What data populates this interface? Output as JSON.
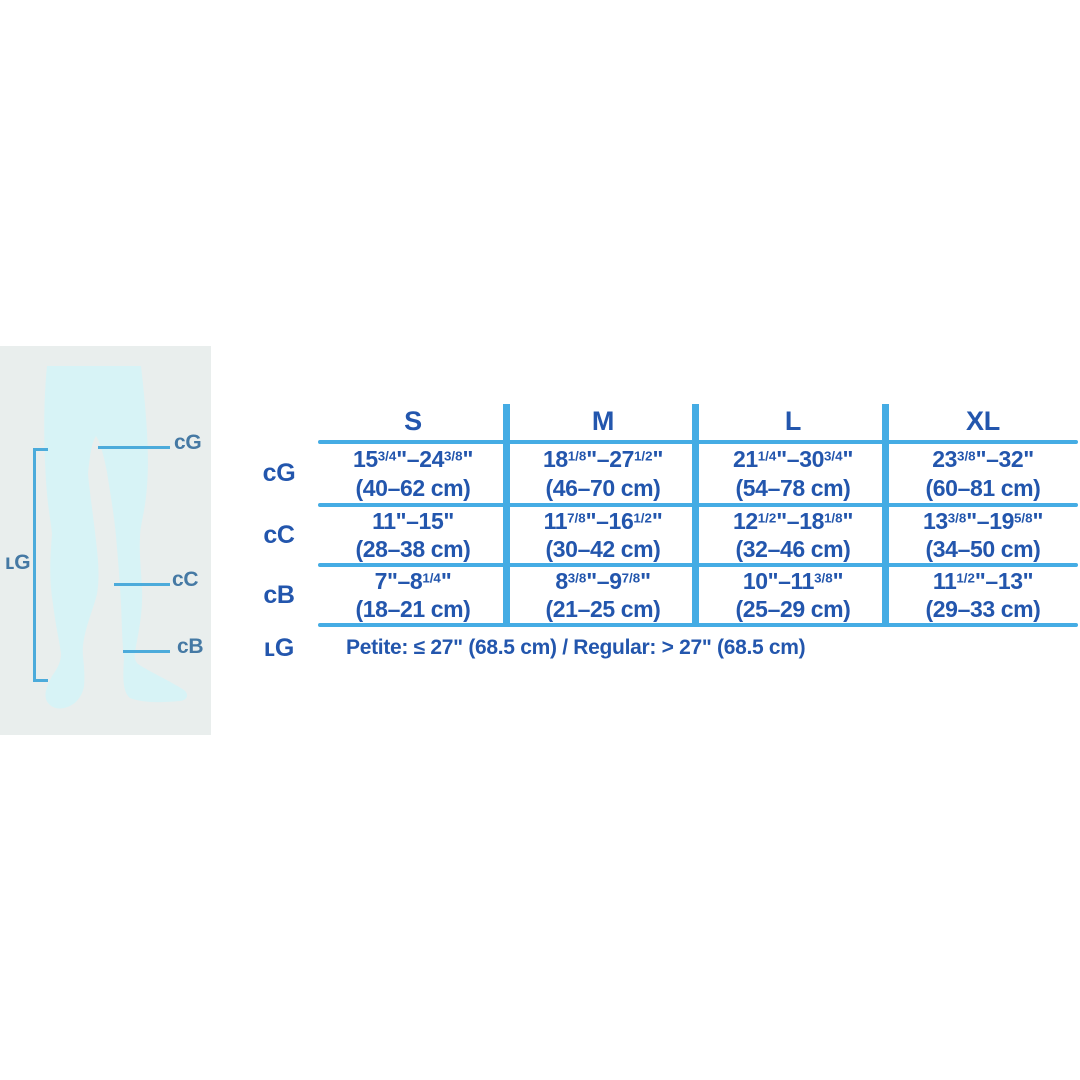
{
  "colors": {
    "t-blue": "#2356ad",
    "line-blue": "#45ace4",
    "d-line": "#4cabdb",
    "d-label": "#4579a4",
    "panel-bg": "#e9eeed",
    "legs-fill": "#d7f3f6"
  },
  "diagram": {
    "labels": {
      "cg": "cG",
      "cc": "cC",
      "cb": "cB",
      "lg": "ʟG"
    }
  },
  "table": {
    "columns": [
      "S",
      "M",
      "L",
      "XL"
    ],
    "rows": [
      {
        "label": "cG",
        "cells": [
          {
            "in": "15{3/4}\"–24{3/8}\"",
            "cm": "(40–62 cm)"
          },
          {
            "in": "18{1/8}\"–27{1/2}\"",
            "cm": "(46–70 cm)"
          },
          {
            "in": "21{1/4}\"–30{3/4}\"",
            "cm": "(54–78 cm)"
          },
          {
            "in": "23{3/8}\"–32\"",
            "cm": "(60–81 cm)"
          }
        ]
      },
      {
        "label": "cC",
        "cells": [
          {
            "in": "11\"–15\"",
            "cm": "(28–38 cm)"
          },
          {
            "in": "11{7/8}\"–16{1/2}\"",
            "cm": "(30–42 cm)"
          },
          {
            "in": "12{1/2}\"–18{1/8}\"",
            "cm": "(32–46 cm)"
          },
          {
            "in": "13{3/8}\"–19{5/8}\"",
            "cm": "(34–50 cm)"
          }
        ]
      },
      {
        "label": "cB",
        "cells": [
          {
            "in": "7\"–8{1/4}\"",
            "cm": "(18–21 cm)"
          },
          {
            "in": "8{3/8}\"–9{7/8}\"",
            "cm": "(21–25 cm)"
          },
          {
            "in": "10\"–11{3/8}\"",
            "cm": "(25–29 cm)"
          },
          {
            "in": "11{1/2}\"–13\"",
            "cm": "(29–33 cm)"
          }
        ]
      }
    ],
    "length_row": {
      "label": "ʟG",
      "text": "Petite: ≤ 27\" (68.5 cm) / Regular: > 27\" (68.5 cm)"
    }
  }
}
